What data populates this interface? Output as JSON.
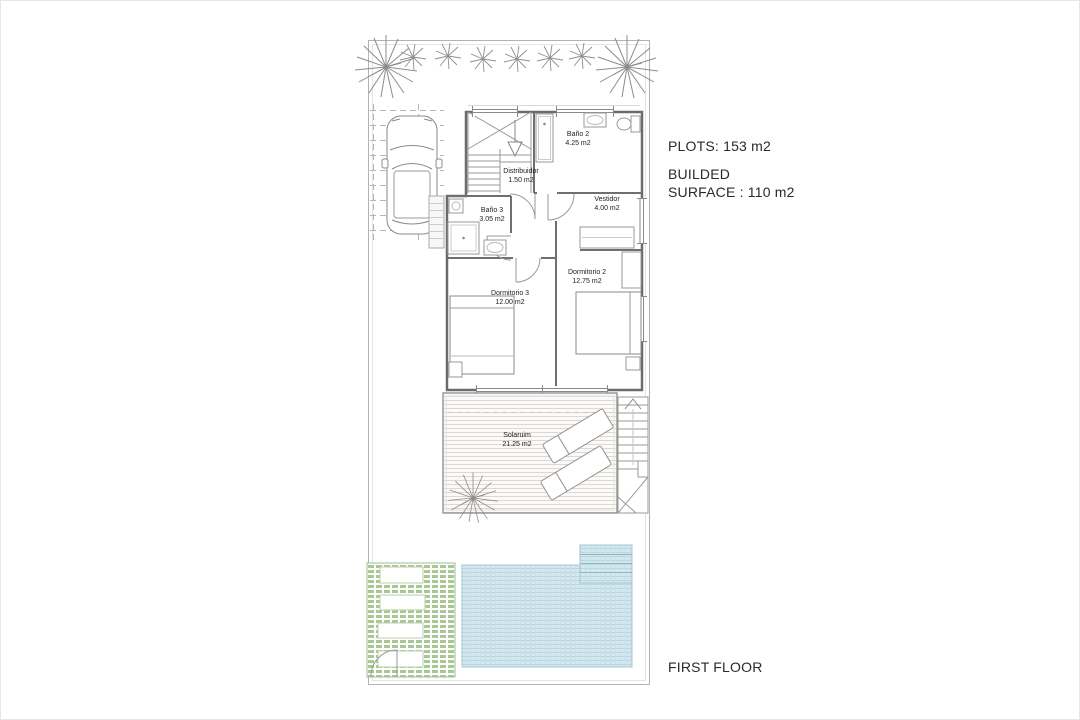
{
  "title": "FIRST FLOOR",
  "annotations": {
    "plots": "PLOTS: 153 m2",
    "built_line1": "BUILDED",
    "built_line2": "SURFACE : 110 m2"
  },
  "rooms": [
    {
      "name": "Baño 2",
      "area": "4.25 m2"
    },
    {
      "name": "Distribuidor",
      "area": "1.50 m2"
    },
    {
      "name": "Baño 3",
      "area": "3.05 m2"
    },
    {
      "name": "Vestidor",
      "area": "4.00 m2"
    },
    {
      "name": "Dormitorio 2",
      "area": "12.75 m2"
    },
    {
      "name": "Dormitorio 3",
      "area": "12.00 m2"
    },
    {
      "name": "Solaruim",
      "area": "21.25 m2"
    }
  ],
  "colors": {
    "pool_water": "#d3e7ef",
    "pool_lines": "#b9d5e1",
    "grass_green": "#a7c892",
    "plan_line_gray": "#999999",
    "wall_gray": "#6b6b6b",
    "text": "#2a2a2a"
  }
}
